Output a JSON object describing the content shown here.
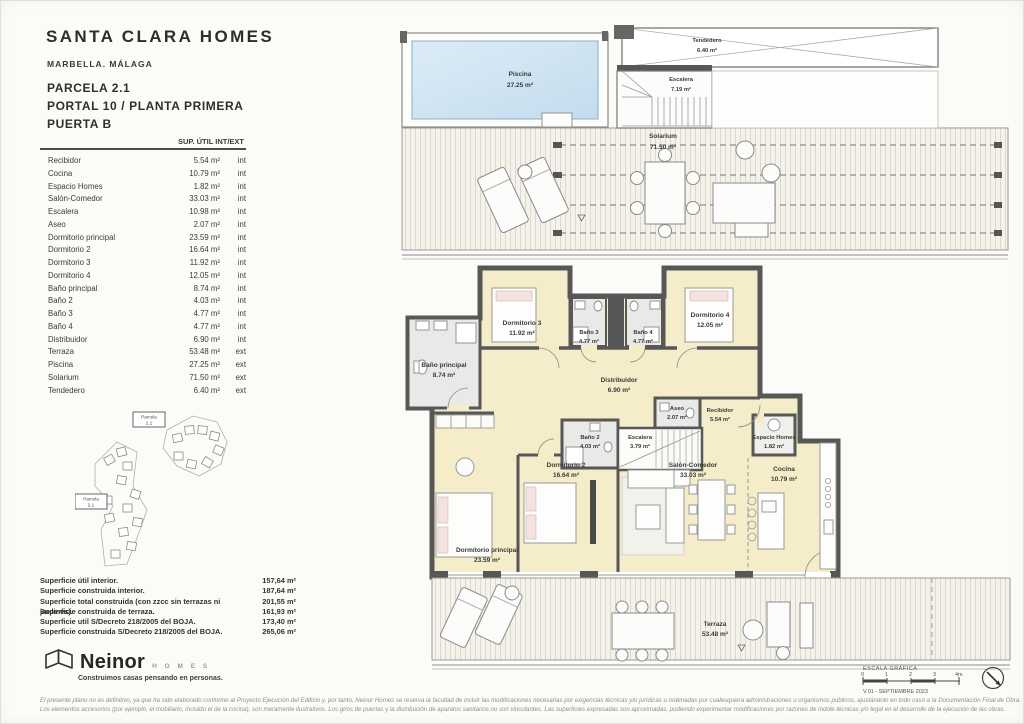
{
  "header": {
    "title": "SANTA CLARA HOMES",
    "subtitle": "MARBELLA. MÁLAGA",
    "parcela": "PARCELA 2.1",
    "portal": "PORTAL 10 / PLANTA PRIMERA",
    "puerta": "PUERTA B"
  },
  "areas_table": {
    "header": "SUP. ÚTIL INT/EXT",
    "rows": [
      {
        "name": "Recibidor",
        "area": "5.54 m²",
        "type": "int"
      },
      {
        "name": "Cocina",
        "area": "10.79 m²",
        "type": "int"
      },
      {
        "name": "Espacio Homes",
        "area": "1.82 m²",
        "type": "int"
      },
      {
        "name": "Salón-Comedor",
        "area": "33.03 m²",
        "type": "int"
      },
      {
        "name": "Escalera",
        "area": "10.98 m²",
        "type": "int"
      },
      {
        "name": "Aseo",
        "area": "2.07 m²",
        "type": "int"
      },
      {
        "name": "Dormitorio principal",
        "area": "23.59 m²",
        "type": "int"
      },
      {
        "name": "Dormitorio 2",
        "area": "16.64 m²",
        "type": "int"
      },
      {
        "name": "Dormitorio 3",
        "area": "11.92 m²",
        "type": "int"
      },
      {
        "name": "Dormitorio 4",
        "area": "12.05 m²",
        "type": "int"
      },
      {
        "name": "Baño principal",
        "area": "8.74 m²",
        "type": "int"
      },
      {
        "name": "Baño 2",
        "area": "4.03 m²",
        "type": "int"
      },
      {
        "name": "Baño 3",
        "area": "4.77 m²",
        "type": "int"
      },
      {
        "name": "Baño 4",
        "area": "4.77 m²",
        "type": "int"
      },
      {
        "name": "Distribuidor",
        "area": "6.90 m²",
        "type": "int"
      },
      {
        "name": "Terraza",
        "area": "53.48 m²",
        "type": "ext"
      },
      {
        "name": "Piscina",
        "area": "27.25 m²",
        "type": "ext"
      },
      {
        "name": "Solarium",
        "area": "71.50 m²",
        "type": "ext"
      },
      {
        "name": "Tendedero",
        "area": "6.40 m²",
        "type": "ext"
      }
    ]
  },
  "summary": {
    "rows": [
      {
        "label": "Superficie útil interior.",
        "value": "157,64 m²"
      },
      {
        "label": "Superficie construida interior.",
        "value": "187,64 m²"
      },
      {
        "label": "Superficie total construida (con zzcc sin terrazas ni jardines).",
        "value": "201,55 m²"
      },
      {
        "label": "Superficie construida de terraza.",
        "value": "161,93 m²"
      },
      {
        "label": "Superficie util S/Decreto 218/2005 del BOJA.",
        "value": "173,40 m²"
      },
      {
        "label": "Superficie construida S/Decreto 218/2005 del BOJA.",
        "value": "265,06 m²"
      }
    ]
  },
  "site_map": {
    "label_line1": "Parcela",
    "label_line2": "2.1"
  },
  "logo": {
    "brand": "Neinor",
    "brand_sub": "H O M E S",
    "tagline": "Construimos casas pensando en personas."
  },
  "plan": {
    "rooms": {
      "piscina": {
        "name": "Piscina",
        "area": "27.25 m²"
      },
      "tendedero": {
        "name": "Tendedero",
        "area": "6.40 m²"
      },
      "escalera_top": {
        "name": "Escalera",
        "area": "7.19 m²"
      },
      "solarium": {
        "name": "Solarium",
        "area": "71.50 m²"
      },
      "dormitorio3": {
        "name": "Dormitorio 3",
        "area": "11.92 m²"
      },
      "bano3": {
        "name": "Baño 3",
        "area": "4.77 m²"
      },
      "bano4": {
        "name": "Baño 4",
        "area": "4.77 m²"
      },
      "dormitorio4": {
        "name": "Dormitorio 4",
        "area": "12.05 m²"
      },
      "bano_principal": {
        "name": "Baño principal",
        "area": "8.74 m²"
      },
      "distribuidor": {
        "name": "Distribuidor",
        "area": "6.90 m²"
      },
      "aseo": {
        "name": "Aseo",
        "area": "2.07 m²"
      },
      "recibidor": {
        "name": "Recibidor",
        "area": "5.54 m²"
      },
      "espacio_homes": {
        "name": "Espacio Homes",
        "area": "1.82 m²"
      },
      "bano2": {
        "name": "Baño 2",
        "area": "4.03 m²"
      },
      "escalera_main": {
        "name": "Escalera",
        "area": "3.79 m²"
      },
      "dormitorio2": {
        "name": "Dormitorio 2",
        "area": "16.64 m²"
      },
      "salon": {
        "name": "Salón-Comedor",
        "area": "33.03 m²"
      },
      "cocina": {
        "name": "Cocina",
        "area": "10.79 m²"
      },
      "dormitorio_principal": {
        "name": "Dormitorio principal",
        "area": "23.59 m²"
      },
      "terraza": {
        "name": "Terraza",
        "area": "53.48 m²"
      }
    },
    "scale": {
      "title": "ESCALA GRÁFICA",
      "ticks": [
        "0",
        "1",
        "2",
        "3",
        "4m"
      ],
      "version": "V.01 - SEPTIEMBRE 2023"
    }
  },
  "disclaimer": {
    "line1": "El presente plano no es definitivo, ya que ha sido elaborado conforme al Proyecto Ejecución del Edificio y, por tanto, Neinor Homes se reserva la facultad de incluir las modificaciones necesarias por exigencias técnicas y/o jurídicas u ordenadas por cualesquiera administraciones u organismos públicos, ajustándolo en todo caso a la Documentación Final de Obra.",
    "line2": "Los elementos accesorios (por ejemplo, el mobiliario, incluido el de la cocina), son meramente ilustrativos. Los giros de puertas y la distribución de aparatos sanitarios no son vinculantes. Las superficies expresadas son aproximadas, pudiendo experimentar modificaciones por razones de índole técnicas y/o legal en el desarrollo de la ejecución de las obras."
  },
  "colors": {
    "room_fill": "#f5ecca",
    "wall": "#575757",
    "pool": "#cfe4f2",
    "bath_fill": "#e9e9e7",
    "deck_line": "#dcd8cc"
  }
}
